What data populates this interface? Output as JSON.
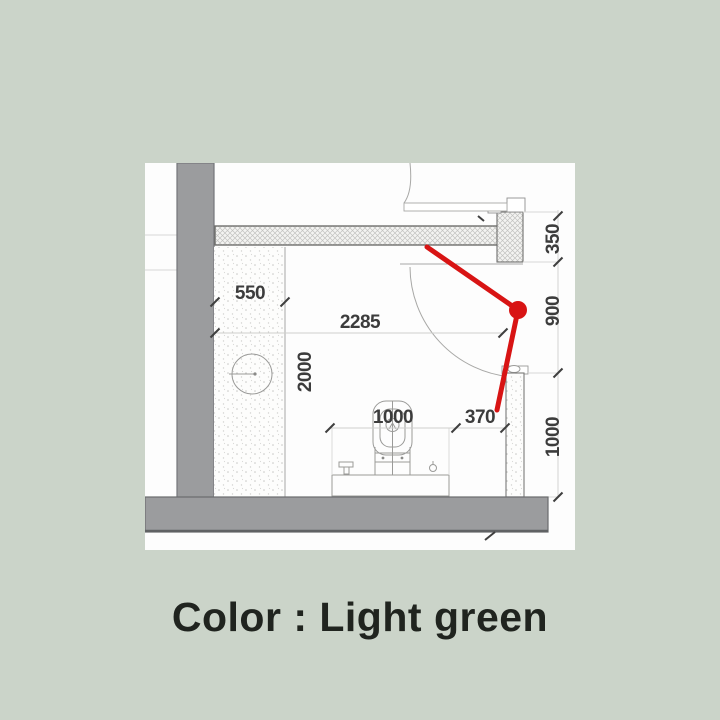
{
  "colors": {
    "bg": "#cbd4c9",
    "panel": "#fdfdfd",
    "red": "#d81414",
    "wall-gray": "#9b9c9e",
    "dim-text": "#3c3c3c",
    "text-dark": "#20241f"
  },
  "caption": "Color : Light green",
  "plan": {
    "dimensions": {
      "shelf_depth": "550",
      "room_width": "2285",
      "room_depth": "2000",
      "fixture_width": "1000",
      "door_side_gap": "370",
      "right_top": "350",
      "right_middle": "900",
      "right_bottom": "1000"
    }
  }
}
